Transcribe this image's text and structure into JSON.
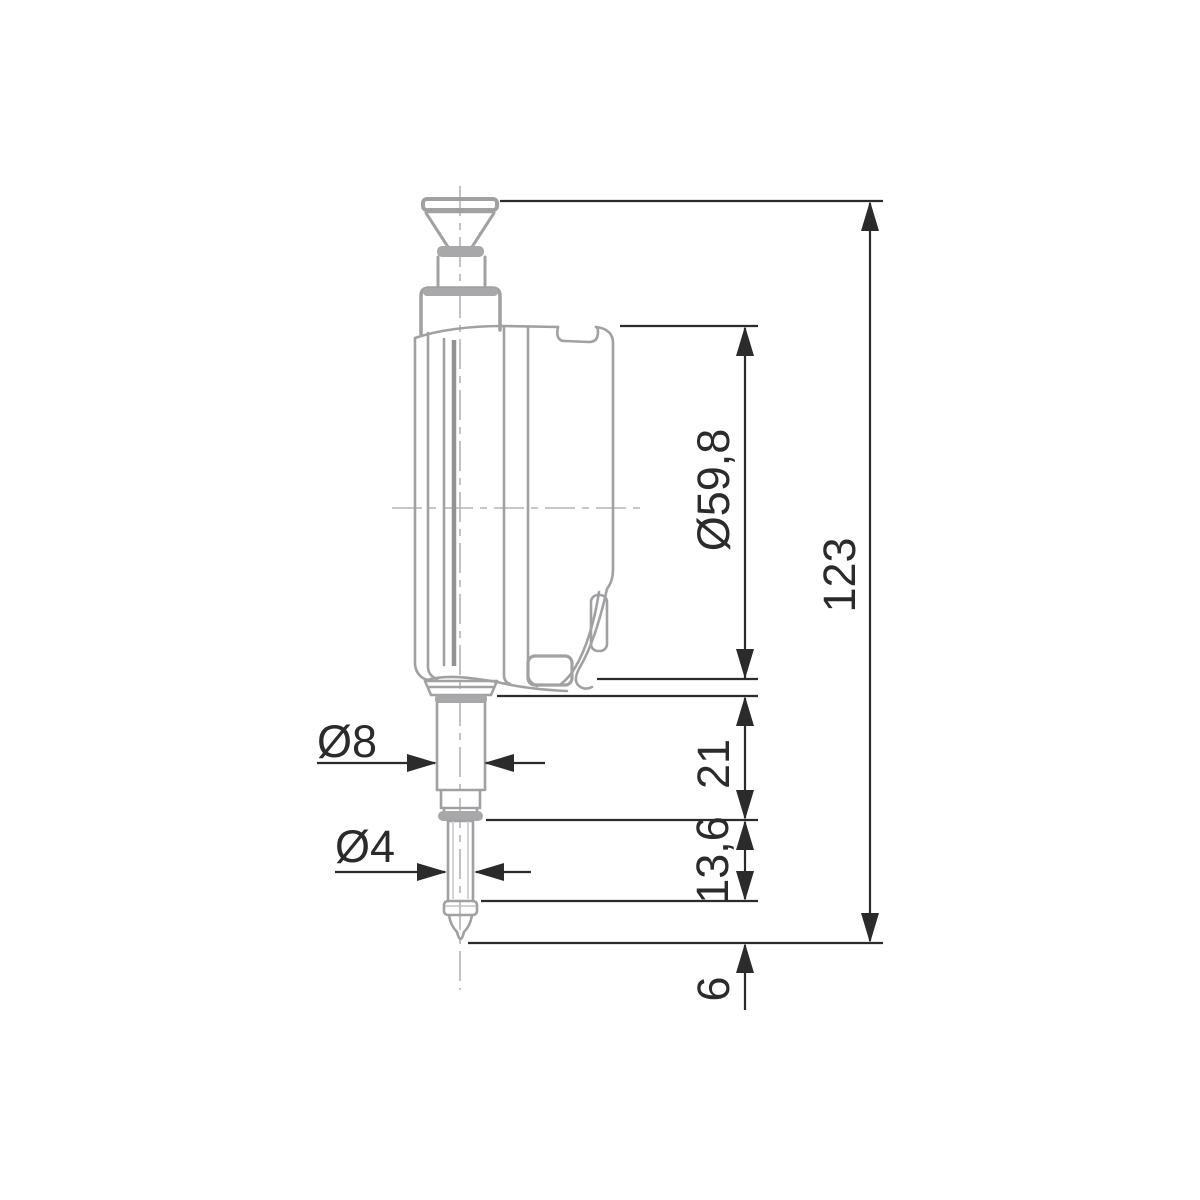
{
  "drawing": {
    "labels": {
      "body_diameter": "Ø59,8",
      "overall_height": "123",
      "stem_length": "21",
      "spindle_length": "13,6",
      "tip_length": "6",
      "stem_diameter": "Ø8",
      "tip_diameter": "Ø4"
    },
    "colors": {
      "device_outline": "#a1a1a3",
      "device_fill": "#a8a8aa",
      "dimension_dark": "#2b2b2b",
      "background": "#ffffff"
    }
  }
}
